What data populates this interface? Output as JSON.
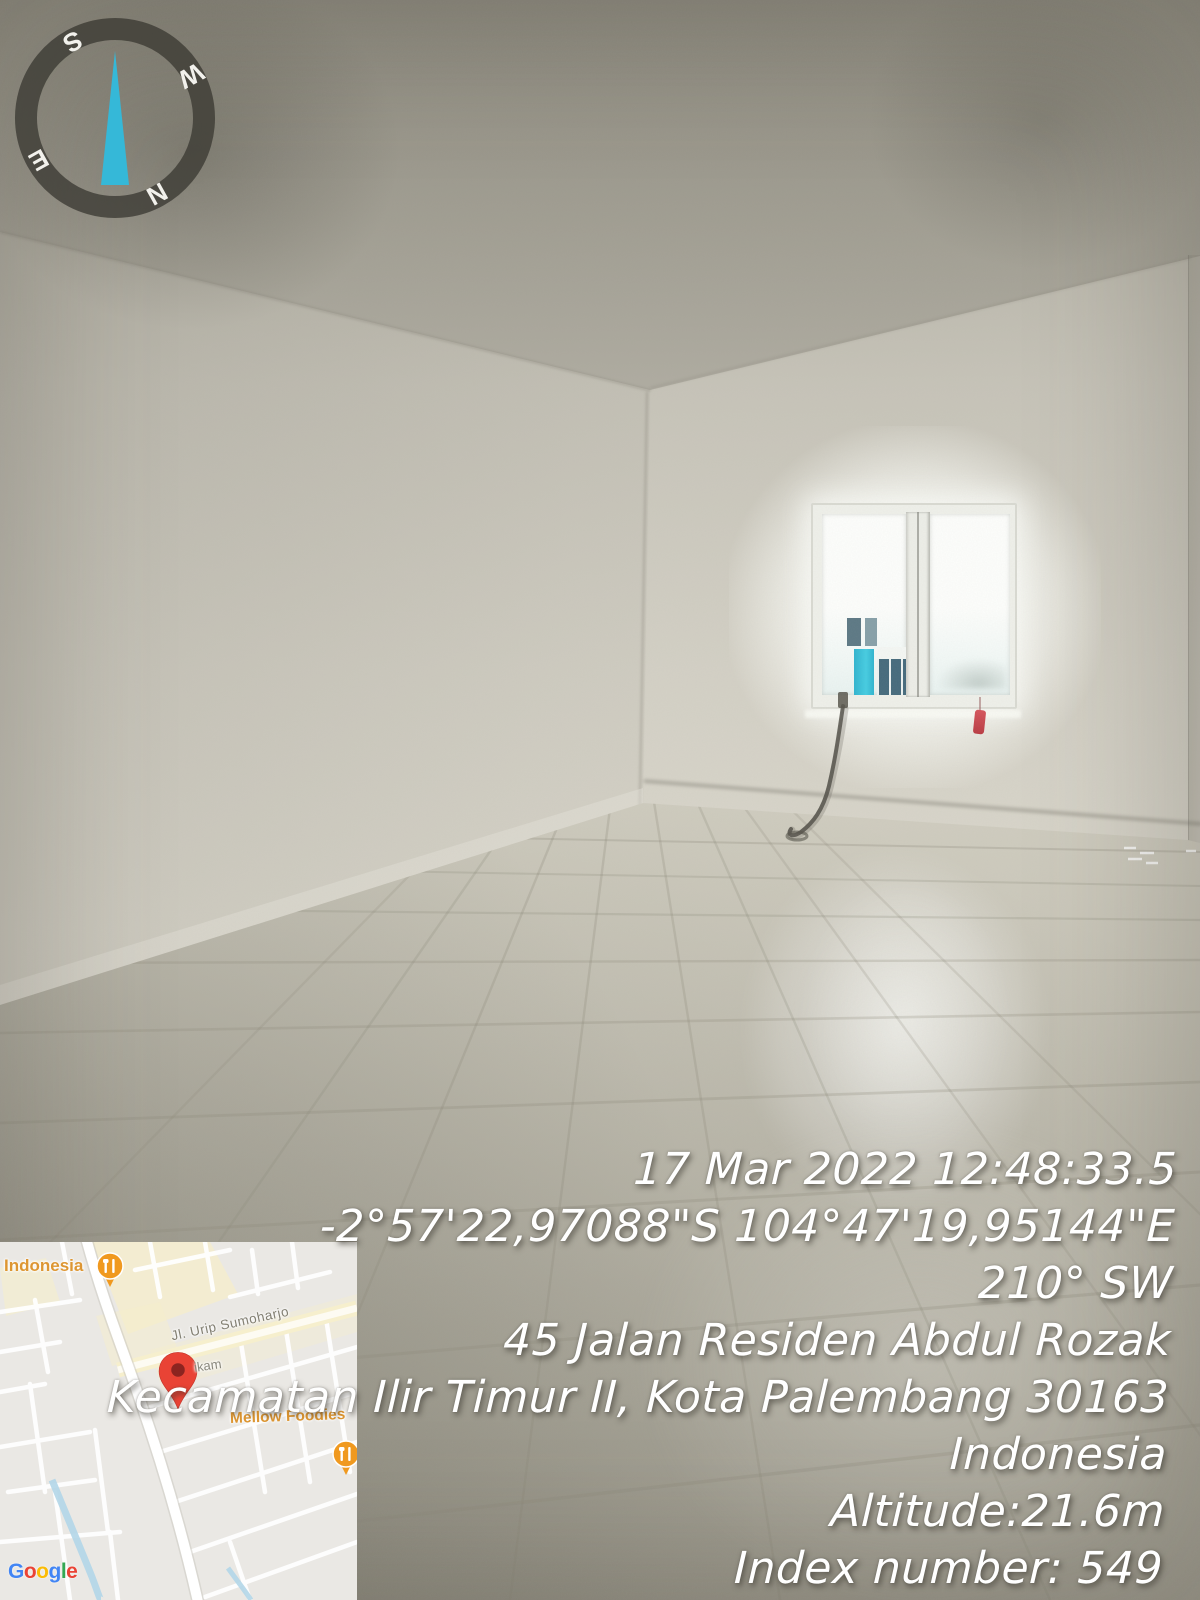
{
  "photo": {
    "scene": "empty tiled room with bright window",
    "colors": {
      "wall": "#cfccc1",
      "wall_dark": "#a29f94",
      "floor": "#c2bfb2",
      "window_light": "#fbfcf8",
      "building_cyan": "#3ac4dc",
      "building_navy": "#456a7c",
      "cable": "#4f4d45",
      "red_tag": "#cc4448"
    }
  },
  "compass": {
    "letters": [
      "N",
      "E",
      "S",
      "W"
    ],
    "rotation_deg": 151,
    "ring_color": "#38372f",
    "needle_color": "#35b8d8"
  },
  "map": {
    "labels": {
      "region": "Indonesia",
      "street": "Jl. Urip Sumoharjo",
      "street_partial": "ikam",
      "poi": "Mellow Foodies"
    },
    "attribution_letters": [
      {
        "ch": "G",
        "color": "#4285F4"
      },
      {
        "ch": "o",
        "color": "#EA4335"
      },
      {
        "ch": "o",
        "color": "#FBBC05"
      },
      {
        "ch": "g",
        "color": "#4285F4"
      },
      {
        "ch": "l",
        "color": "#34A853"
      },
      {
        "ch": "e",
        "color": "#EA4335"
      }
    ],
    "colors": {
      "background": "#eae8e4",
      "road_white": "#ffffff",
      "road_yellow": "#f6efcd",
      "river": "#aed4e6",
      "label_orange": "#dd9632",
      "label_gray": "#8a887c",
      "pin_orange": "#f0991f",
      "pin_red": "#e94335"
    }
  },
  "overlay": {
    "lines": [
      "17 Mar 2022 12:48:33.5",
      "-2°57'22,97088\"S 104°47'19,95144\"E",
      "210° SW",
      "45 Jalan Residen Abdul Rozak",
      "Kecamatan Ilir Timur II, Kota Palembang 30163",
      "Indonesia",
      "Altitude:21.6m",
      "Index number: 549"
    ],
    "text_color": "#ffffff"
  }
}
